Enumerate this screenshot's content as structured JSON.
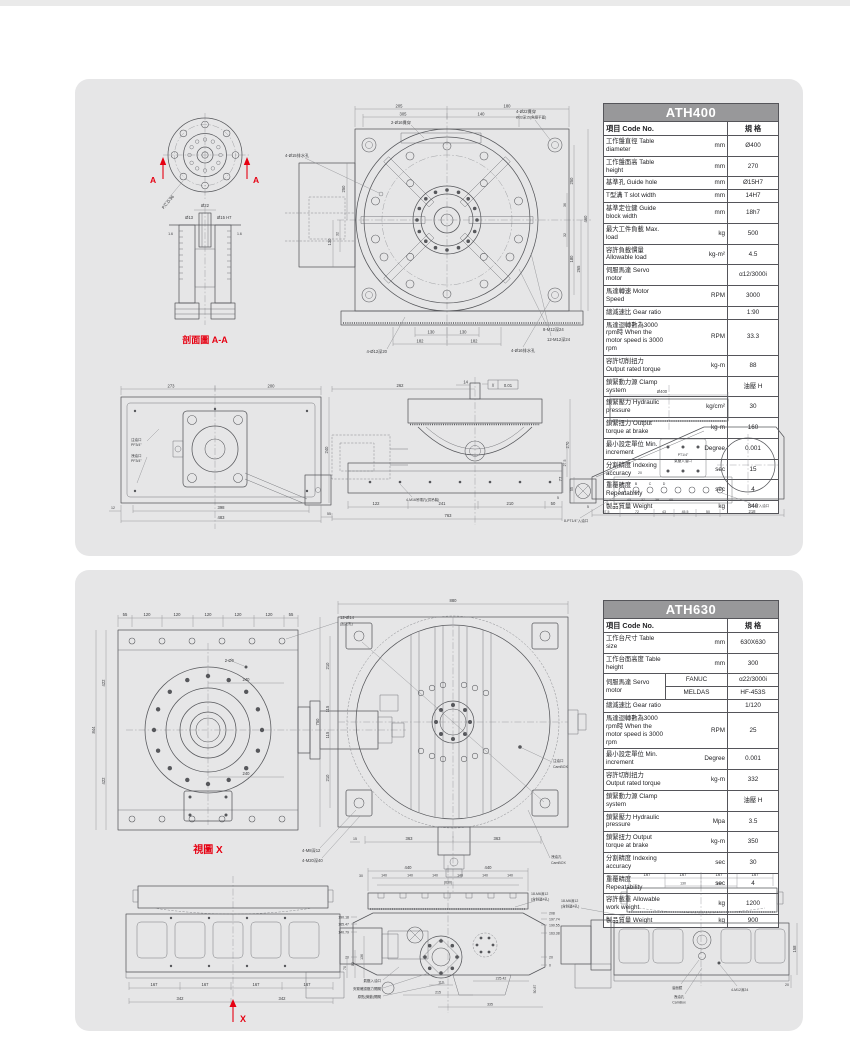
{
  "page": {
    "top_strip_color": "#eaeaea",
    "panel_color": "#e6e6e7",
    "accent_red": "#e60012",
    "table_header_bg": "#98989a"
  },
  "ath400": {
    "table": {
      "title": "ATH400",
      "col_item": "項目 Code No.",
      "col_spec": "規 格",
      "rows": [
        {
          "label": "工作盤直徑 Table diameter",
          "unit": "mm",
          "value": "Ø400"
        },
        {
          "label": "工作盤面高 Table height",
          "unit": "mm",
          "value": "270"
        },
        {
          "label": "基準孔 Guide hole",
          "unit": "mm",
          "value": "Ø15H7"
        },
        {
          "label": "T型溝 T slot width",
          "unit": "mm",
          "value": "14H7"
        },
        {
          "label": "基準定位鍵 Guide block width",
          "unit": "mm",
          "value": "18h7"
        },
        {
          "label": "最大工件負載 Max. load",
          "unit": "kg",
          "value": "500"
        },
        {
          "label": "容許負載慣量 Allowable load",
          "unit": "kg-m²",
          "value": "4.5"
        },
        {
          "label": "伺服馬達 Servo motor",
          "unit": "",
          "value": "α12/3000i"
        },
        {
          "label": "馬達轉速 Motor Speed",
          "unit": "RPM",
          "value": "3000"
        },
        {
          "label": "總減速比 Gear ratio",
          "unit": "",
          "value": "1:90"
        },
        {
          "label": "馬達迴轉數為3000 rpm時 When the motor speed is 3000 rpm",
          "unit": "RPM",
          "value": "33.3"
        },
        {
          "label": "容許切削扭力 Output rated torque",
          "unit": "kg-m",
          "value": "88"
        },
        {
          "label": "鎖緊動力源 Clamp system",
          "unit": "",
          "value": "油壓 H"
        },
        {
          "label": "鎖緊壓力 Hydraulic pressure",
          "unit": "kg/cm²",
          "value": "30"
        },
        {
          "label": "鎖緊扭力 Output torque at brake",
          "unit": "kg-m",
          "value": "160"
        },
        {
          "label": "最小設定單位 Min. increment",
          "unit": "Degree",
          "value": "0.001"
        },
        {
          "label": "分割精度 Indexing accuracy",
          "unit": "sec",
          "value": "15"
        },
        {
          "label": "重覆精度 Repeatability",
          "unit": "sec",
          "value": "4"
        },
        {
          "label": "製品質量 Weight",
          "unit": "kg",
          "value": "340"
        }
      ]
    },
    "section": {
      "caption": "剖面圖 A-A",
      "arrow_label": "A",
      "pcd": "P.C.D.96",
      "dia22": "Ø22",
      "dia13": "Ø13",
      "dia15": "Ø15 H7",
      "fin": "1.6"
    },
    "front": {
      "dims": {
        "d205": "205",
        "d180": "180",
        "d305": "305",
        "d140": "140",
        "d250": "250",
        "d130": "130",
        "d32": "32",
        "d36": "36",
        "d460": "460",
        "d265": "265",
        "d182": "182",
        "d180v": "180"
      },
      "callouts": {
        "c16": "2-Ø16貫穿",
        "drain15": "4-Ø15排水孔",
        "c22a": "4-Ø22貫穿",
        "c22b": "Ø33深15(魚眼平面)",
        "m12x8": "8-M12深24",
        "m12x12": "12-M12深24",
        "drain16": "4-Ø16排水孔",
        "c12": "4-Ø12深20"
      }
    },
    "side_left": {
      "dims": {
        "d273": "273",
        "d200": "200",
        "d398": "398",
        "d483": "483",
        "d55": "55",
        "d12": "12",
        "d240": "240"
      },
      "callouts": {
        "oil_in1": "注油口",
        "oil_in2": "PF3/4\"",
        "oil_out1": "洩油口",
        "oil_out2": "PF3/4\""
      }
    },
    "elevation": {
      "dims": {
        "d262": "262",
        "d14": "14",
        "flat_sym": "//",
        "flat_val": "0.01",
        "d270": "270",
        "d77": "77",
        "d5": "5",
        "d122": "122",
        "d241": "241",
        "d210": "210",
        "d50": "50",
        "d763": "763"
      },
      "callouts": {
        "lift": "4-M16吊環孔(供吊裝)"
      }
    },
    "side_right": {
      "dims": {
        "d400": "Ø400",
        "d27_5": "27.5",
        "d55": "55",
        "d5": "5",
        "d20": "20",
        "d45": "45",
        "d37": "37",
        "d39": "39",
        "d40": "40",
        "d57_5": "57.5",
        "d72": "72",
        "d43": "43",
        "d45_5": "45.5",
        "d50": "50",
        "d218": "218",
        "pa": "A",
        "pb": "B",
        "pc": "C",
        "pd": "D"
      },
      "callouts": {
        "air1": "PT1/4\"",
        "air2": "氣壓入油口",
        "in8": "8-PT1/4\"入油口",
        "in1": "PT1/4\"入油口"
      }
    }
  },
  "ath630": {
    "table": {
      "title": "ATH630",
      "col_item": "項目 Code No.",
      "col_spec": "規 格",
      "rows_top": [
        {
          "label": "工作台尺寸 Table size",
          "unit": "mm",
          "value": "630X630"
        },
        {
          "label": "工作台面高度 Table height",
          "unit": "mm",
          "value": "300"
        }
      ],
      "servo": {
        "label": "伺服馬達 Servo motor",
        "fanuc": "FANUC",
        "fanuc_value": "α22/3000i",
        "meldas": "MELDAS",
        "meldas_value": "HF-453S"
      },
      "rows": [
        {
          "label": "總減速比 Gear ratio",
          "unit": "",
          "value": "1/120"
        },
        {
          "label": "馬達迴轉數為3000 rpm時 When the motor speed is 3000 rpm",
          "unit": "RPM",
          "value": "25"
        },
        {
          "label": "最小設定單位 Min. increment",
          "unit": "Degree",
          "value": "0.001"
        },
        {
          "label": "容許切削扭力 Output rated torque",
          "unit": "kg-m",
          "value": "332"
        },
        {
          "label": "鎖緊動力源 Clamp system",
          "unit": "",
          "value": "油壓 H"
        },
        {
          "label": "鎖緊壓力 Hydraulic pressure",
          "unit": "Mpa",
          "value": "3.5"
        },
        {
          "label": "鎖緊扭力 Output torque at brake",
          "unit": "kg-m",
          "value": "350"
        },
        {
          "label": "分割精度 Indexing accuracy",
          "unit": "sec",
          "value": "30"
        },
        {
          "label": "重覆精度 Repeatability",
          "unit": "sec",
          "value": "4"
        },
        {
          "label": "容許載重 Allowable work weight",
          "unit": "kg",
          "value": "1200"
        },
        {
          "label": "製品質量 Weight",
          "unit": "kg",
          "value": "900"
        }
      ]
    },
    "bottom_view": {
      "caption": "視圖 X",
      "dims": {
        "d55": "55",
        "d120": "120",
        "d422": "422",
        "d844": "844",
        "d240": "240"
      },
      "callouts": {
        "fix1": "12-Ø14",
        "fix2": "(固定孔)",
        "c26": "2-Ø6"
      }
    },
    "top_view": {
      "dims": {
        "d880": "880",
        "d750": "750",
        "d210": "210",
        "d115": "115",
        "d363": "363",
        "d15": "15"
      },
      "callouts": {
        "m8": "4-M8深12",
        "m20": "4-M20深40",
        "oil1": "注油口",
        "oil2": "CamBOX",
        "drain1": "洩油孔",
        "drain2": "CamBOX"
      }
    },
    "front_view": {
      "arrow_label": "X",
      "dims": {
        "d167": "167",
        "d342": "342",
        "d70": "70",
        "d83": "83",
        "d136": "136"
      }
    },
    "section_view": {
      "dims": {
        "d440": "440",
        "d140": "140",
        "d630": "(630)",
        "d30": "30",
        "r1": "208",
        "r2": "197.74",
        "r3": "190.55",
        "r4": "163.38",
        "r5": "20",
        "r6": "0",
        "l1": "190.18",
        "l2": "165.47",
        "l3": "140.79",
        "l4": "20",
        "b1": "110",
        "b2": "215",
        "b3": "225.42",
        "b4": "335",
        "b5": "50.87"
      },
      "callouts": {
        "air": "氣壓入油口",
        "clamp": "夾緊確認壓力開關",
        "origin": "原點(微動)開關",
        "m6a": "18-M6深12",
        "m6b": "(含斜邊4孔)"
      }
    },
    "side_view": {
      "dims": {
        "d167": "167",
        "d130": "130",
        "d158": "158",
        "d20": "20"
      },
      "callouts": {
        "m6a": "18-M6深12",
        "m6b": "(含斜邊4孔)",
        "sight": "油面鏡",
        "drain1": "洩油孔",
        "drain2": "CamBox",
        "m12": "4-M12深24"
      }
    }
  }
}
